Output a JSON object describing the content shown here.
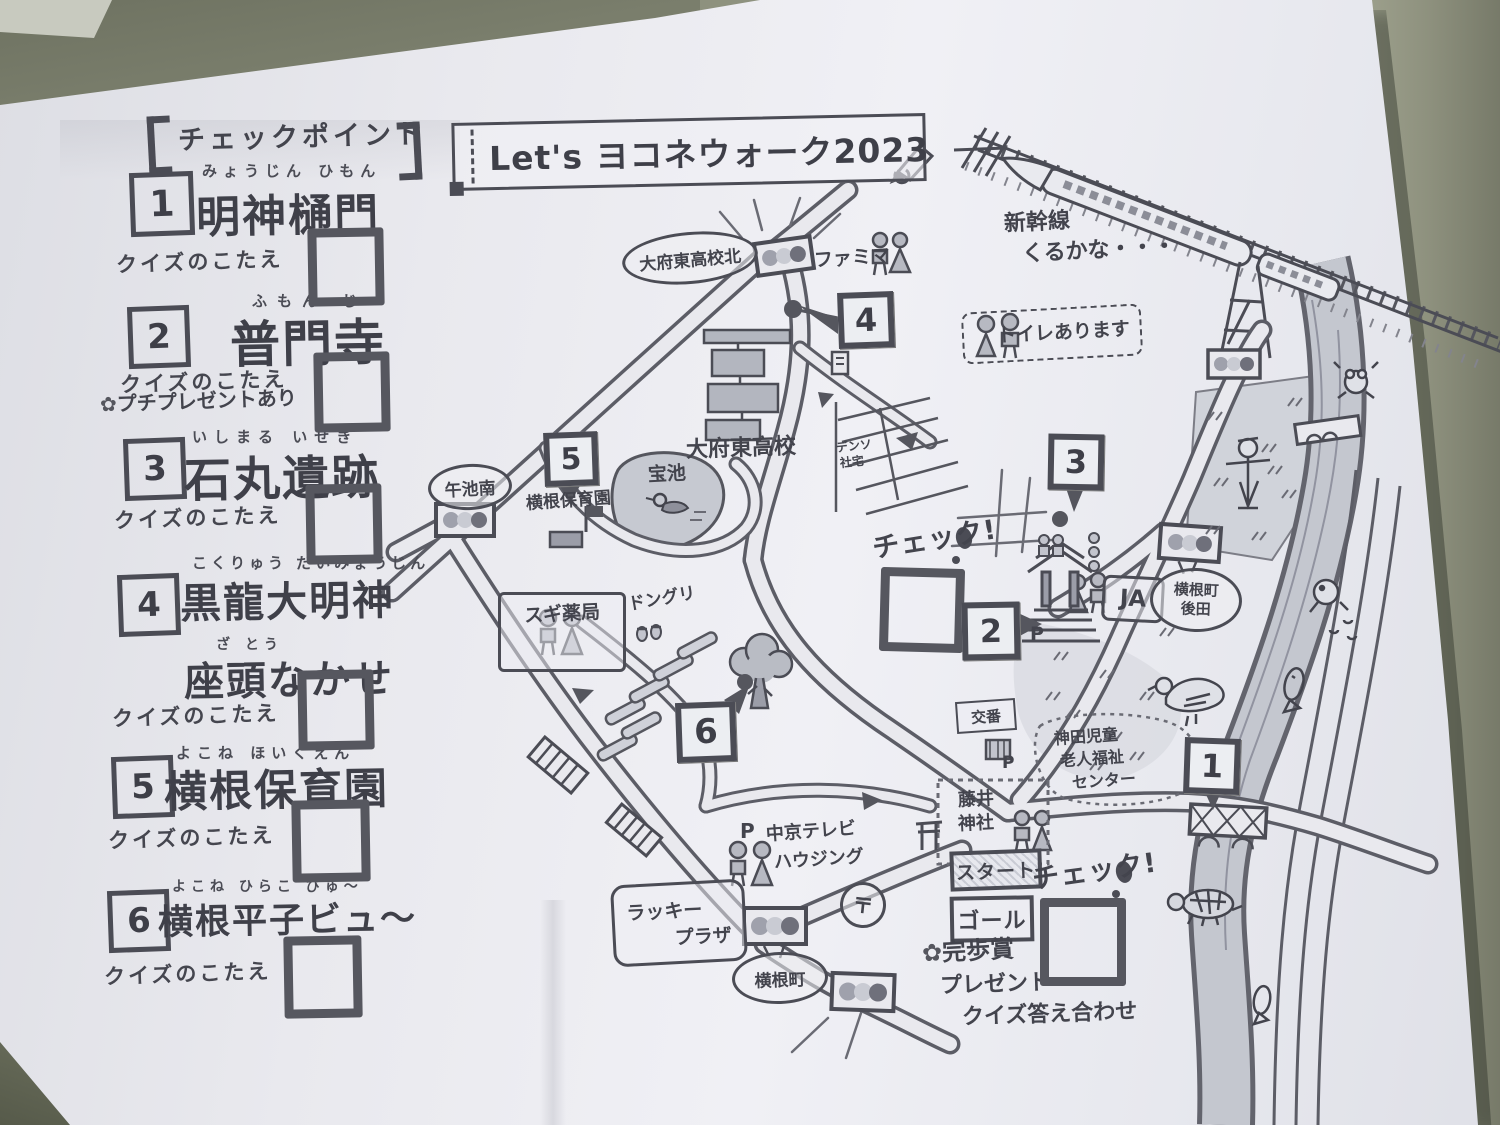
{
  "title": {
    "text": "Let's ヨコネウォーク2023"
  },
  "checkpoints": {
    "header": "チェックポイント",
    "quiz_label": "クイズのこたえ",
    "items": [
      {
        "num": "1",
        "furigana": "みょうじん ひもん",
        "name": "明神樋門"
      },
      {
        "num": "2",
        "furigana": "ふもん じ",
        "name": "普門寺",
        "note": "プチプレゼントあり"
      },
      {
        "num": "3",
        "furigana": "いしまる いせき",
        "name": "石丸遺跡"
      },
      {
        "num": "4",
        "furigana": "こくりゅう だいみょうじん",
        "name": "黒龍大明神",
        "furigana2": "ざ とう",
        "name2": "座頭なかせ"
      },
      {
        "num": "5",
        "furigana": "よこね ほいくえん",
        "name": "横根保育園"
      },
      {
        "num": "6",
        "furigana": "よこね ひらこ びゅ〜",
        "name": "横根平子ビュ〜"
      }
    ]
  },
  "map": {
    "markers": [
      "1",
      "2",
      "3",
      "4",
      "5",
      "6"
    ],
    "labels": {
      "obu_higashi_kita": "大府東高校北",
      "famima": "ファミマ",
      "shinkansen_1": "新幹線",
      "shinkansen_2": "くるかな・・・",
      "toilet_note": "トイレあります",
      "obu_higashi": "大府東高校",
      "denso_1": "デンソ",
      "denso_2": "社宅",
      "check": "チェック!",
      "ja": "JA",
      "yokone_cho": "横根町",
      "ushiroda": "後田",
      "uma_ike_minami": "午池南",
      "yokone_hoikuen": "横根保育園",
      "takara_ike": "宝池",
      "sugi_pharmacy": "スギ薬局",
      "donguri": "ドングリ",
      "chukyo_tv_1": "中京テレビ",
      "chukyo_tv_2": "ハウジング",
      "post_mark": "〒",
      "lucky_plaza_1": "ラッキー",
      "lucky_plaza_2": "プラザ",
      "koban": "交番",
      "kanda_1": "神田児童",
      "kanda_2": "老人福祉",
      "kanda_3": "センター",
      "fujii_1": "藤井",
      "fujii_2": "神社",
      "start": "スタート",
      "goal": "ゴール",
      "kanpo_sho": "完歩賞",
      "present": "プレゼント",
      "quiz_check": "クイズ答え合わせ",
      "p": "P"
    }
  }
}
